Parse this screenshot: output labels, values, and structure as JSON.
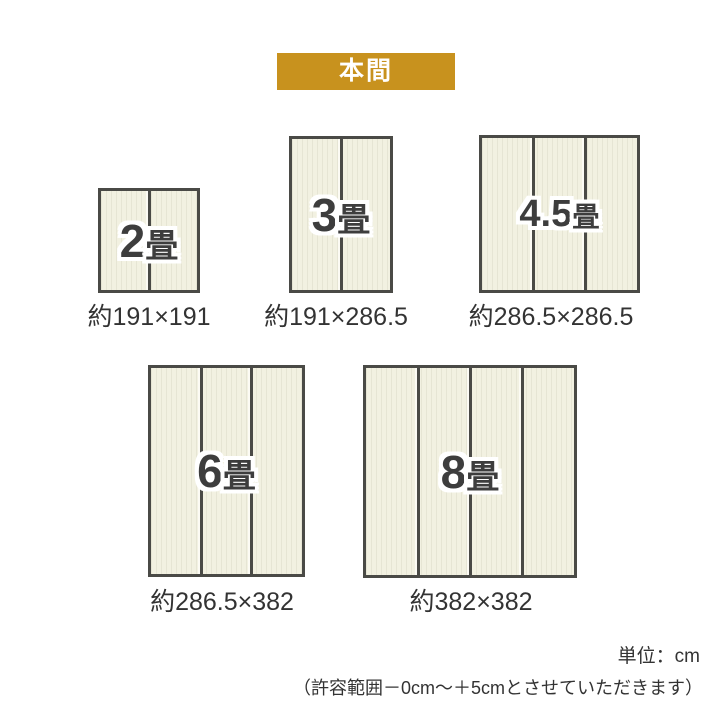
{
  "header": {
    "badge_label": "本間"
  },
  "mats": [
    {
      "name": "2畳",
      "label_num": "2",
      "label_unit": "畳",
      "size_text": "約191×191",
      "panels": 2
    },
    {
      "name": "3畳",
      "label_num": "3",
      "label_unit": "畳",
      "size_text": "約191×286.5",
      "panels": 2
    },
    {
      "name": "4.5畳",
      "label_num": "4.5",
      "label_unit": "畳",
      "size_text": "約286.5×286.5",
      "panels": 3
    },
    {
      "name": "6畳",
      "label_num": "6",
      "label_unit": "畳",
      "size_text": "約286.5×382",
      "panels": 3
    },
    {
      "name": "8畳",
      "label_num": "8",
      "label_unit": "畳",
      "size_text": "約382×382",
      "panels": 4
    }
  ],
  "footer": {
    "unit_text": "単位：cm",
    "tolerance_text": "（許容範囲－0cm～＋5cmとさせていただきます）"
  },
  "colors": {
    "badge_bg": "#C8921E",
    "mat_fill": "#F2F1E1",
    "mat_border": "#4A4A46",
    "label_text": "#3D3D3D",
    "body_text": "#333333"
  }
}
